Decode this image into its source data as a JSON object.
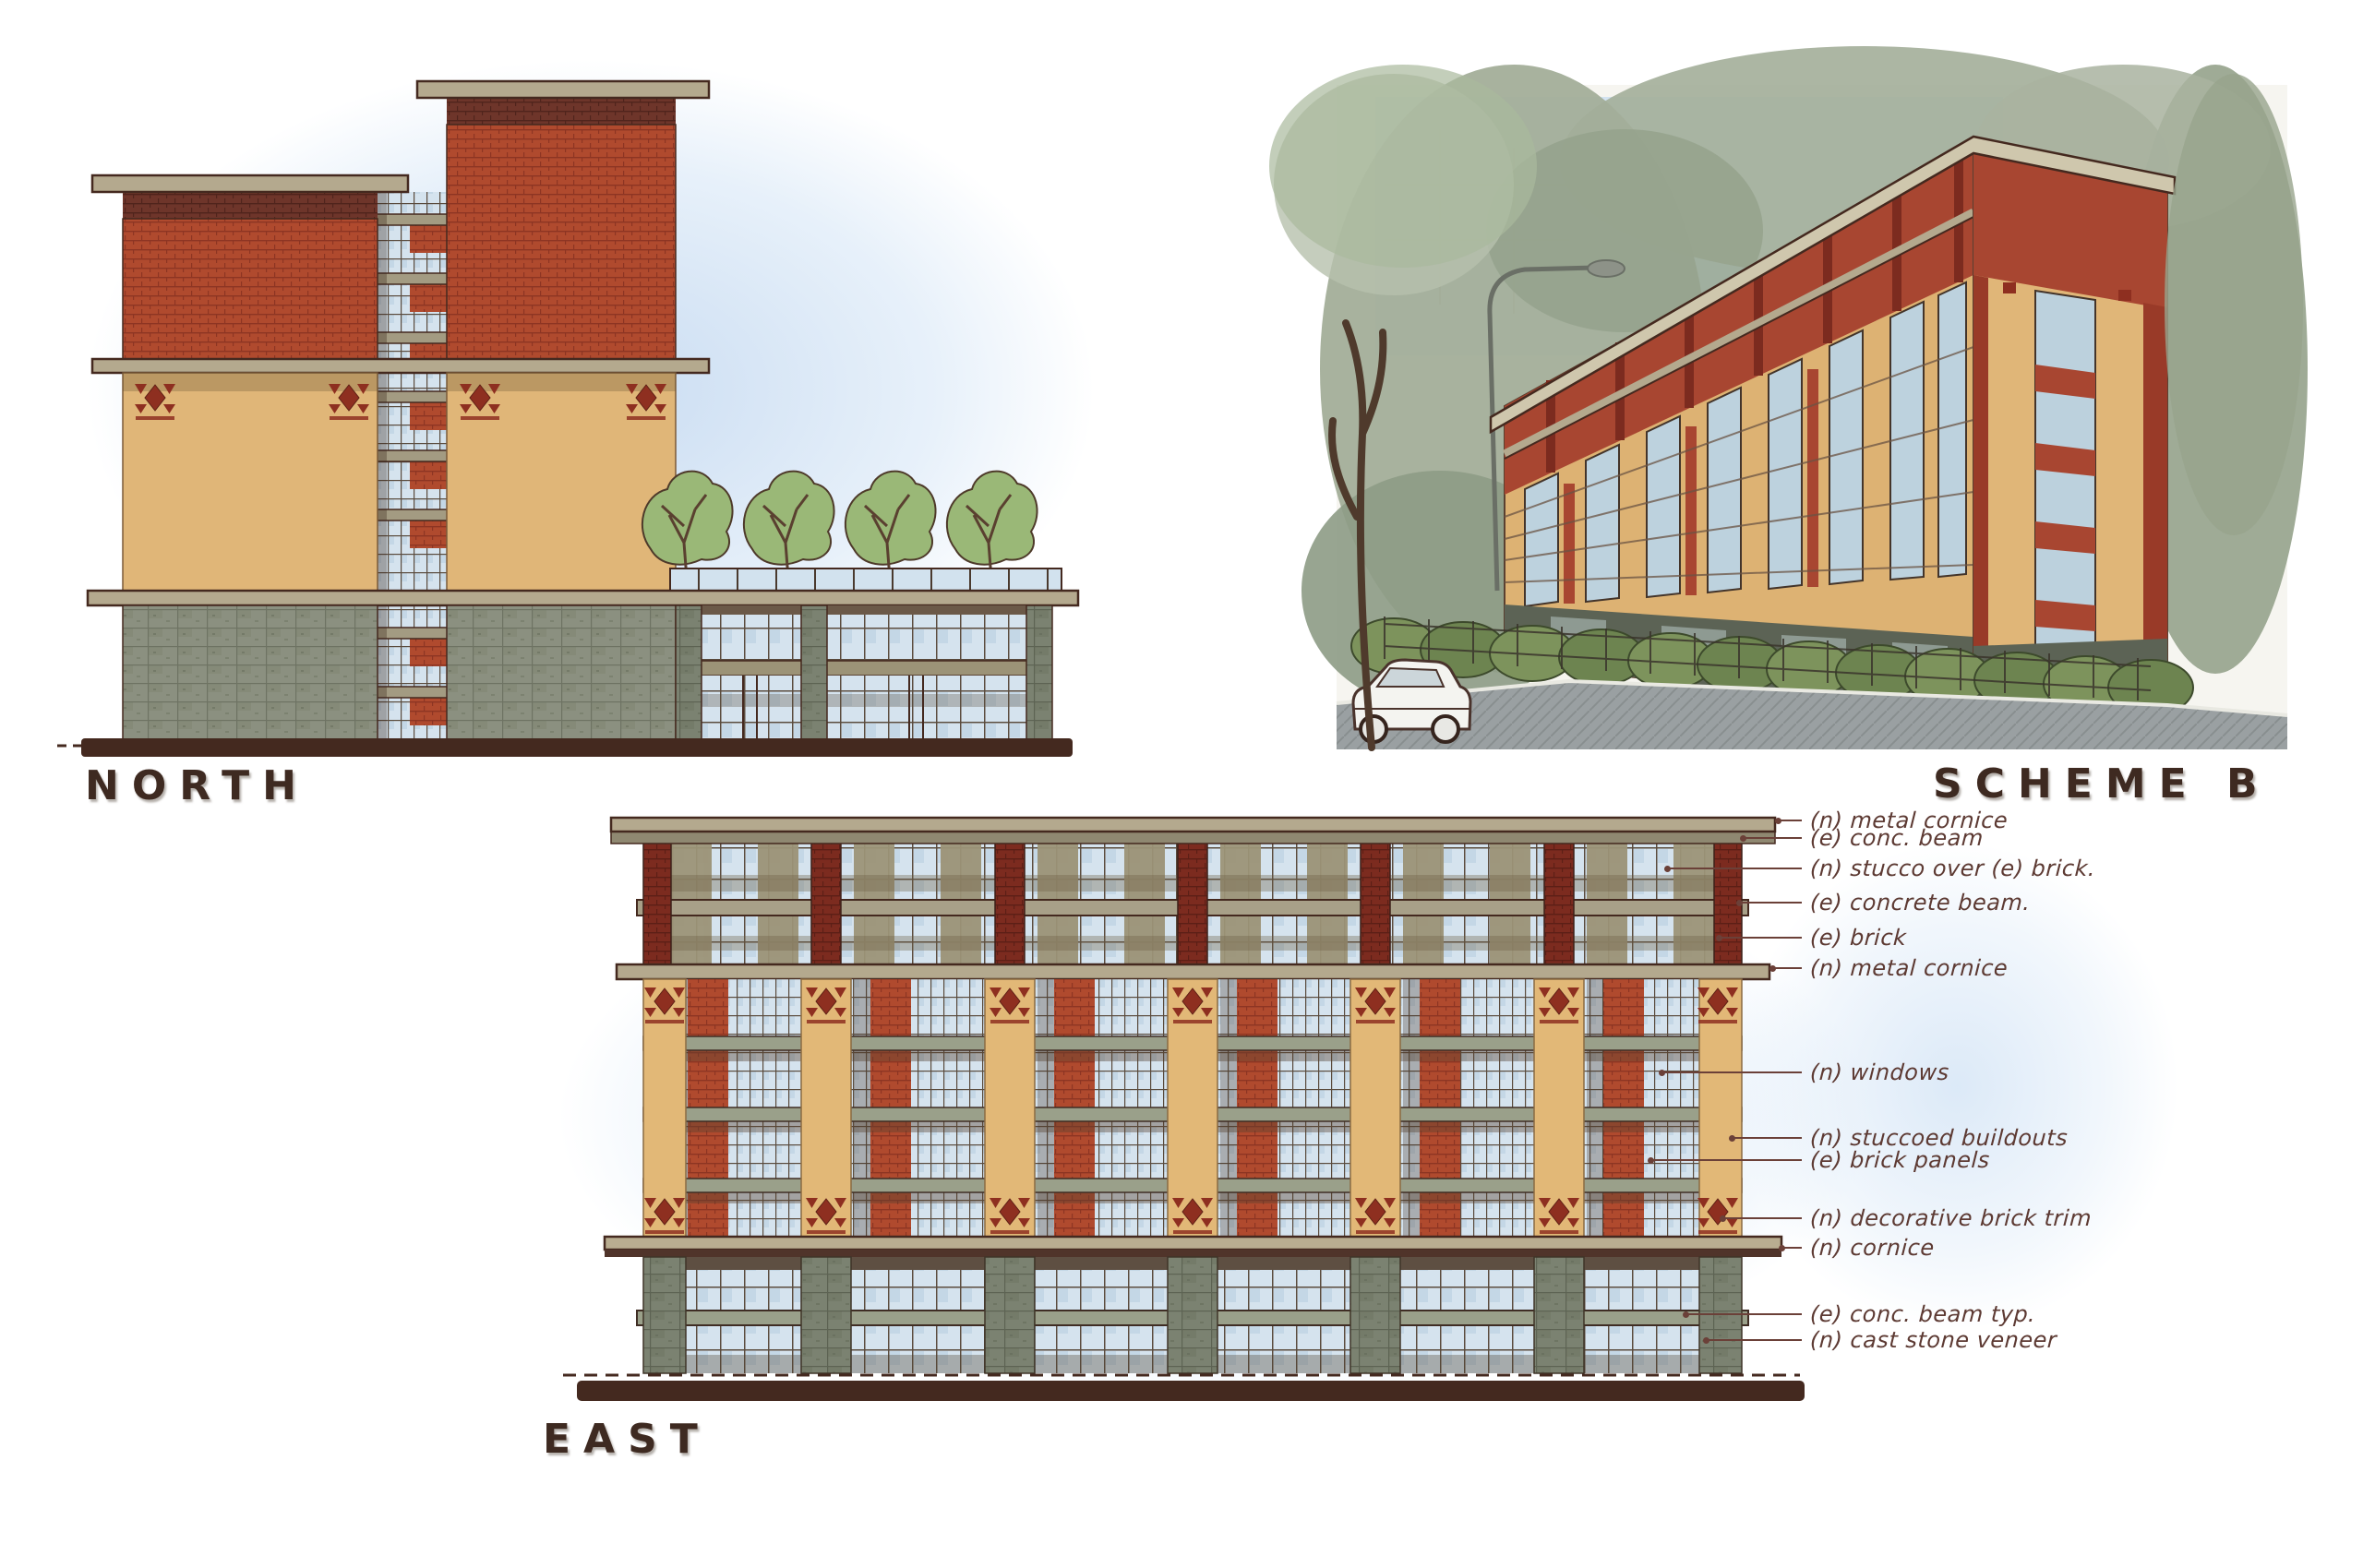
{
  "sheet": {
    "titles": {
      "north": "NORTH",
      "east": "EAST",
      "scheme_b": "SCHEME B"
    }
  },
  "east_annotations": {
    "items": [
      {
        "label": "(n) metal cornice"
      },
      {
        "label": "(e) conc. beam"
      },
      {
        "label": "(n) stucco over (e) brick."
      },
      {
        "label": "(e) concrete beam."
      },
      {
        "label": "(e) brick"
      },
      {
        "label": "(n) metal cornice"
      },
      {
        "label": "(n) windows"
      },
      {
        "label": "(n) stuccoed buildouts"
      },
      {
        "label": "(e) brick panels"
      },
      {
        "label": "(n) decorative brick trim"
      },
      {
        "label": "(n) cornice"
      },
      {
        "label": "(e) conc. beam typ."
      },
      {
        "label": "(n) cast stone veneer"
      }
    ]
  },
  "palette": {
    "paper": "#ffffff",
    "sky_wash": "#d4e5f6",
    "brick_red": "#b04a2e",
    "brick_dark_red": "#7c2b1f",
    "brick_band_dark": "#6e352a",
    "tan_stucco": "#e0b678",
    "olive_band": "#9c9377",
    "slab_concrete": "#b4a98e",
    "stone_veneer": "#8b9080",
    "glass_blue": "#d5e3ee",
    "tree_green": "#9ab877",
    "shrub_green": "#7d935c",
    "backdrop_green_gray": "#a3ae99",
    "street_gray": "#9aa0a2",
    "ink_outline": "#44291f",
    "annotation_ink": "#5d3a33",
    "title_ink": "#3e2a21"
  }
}
